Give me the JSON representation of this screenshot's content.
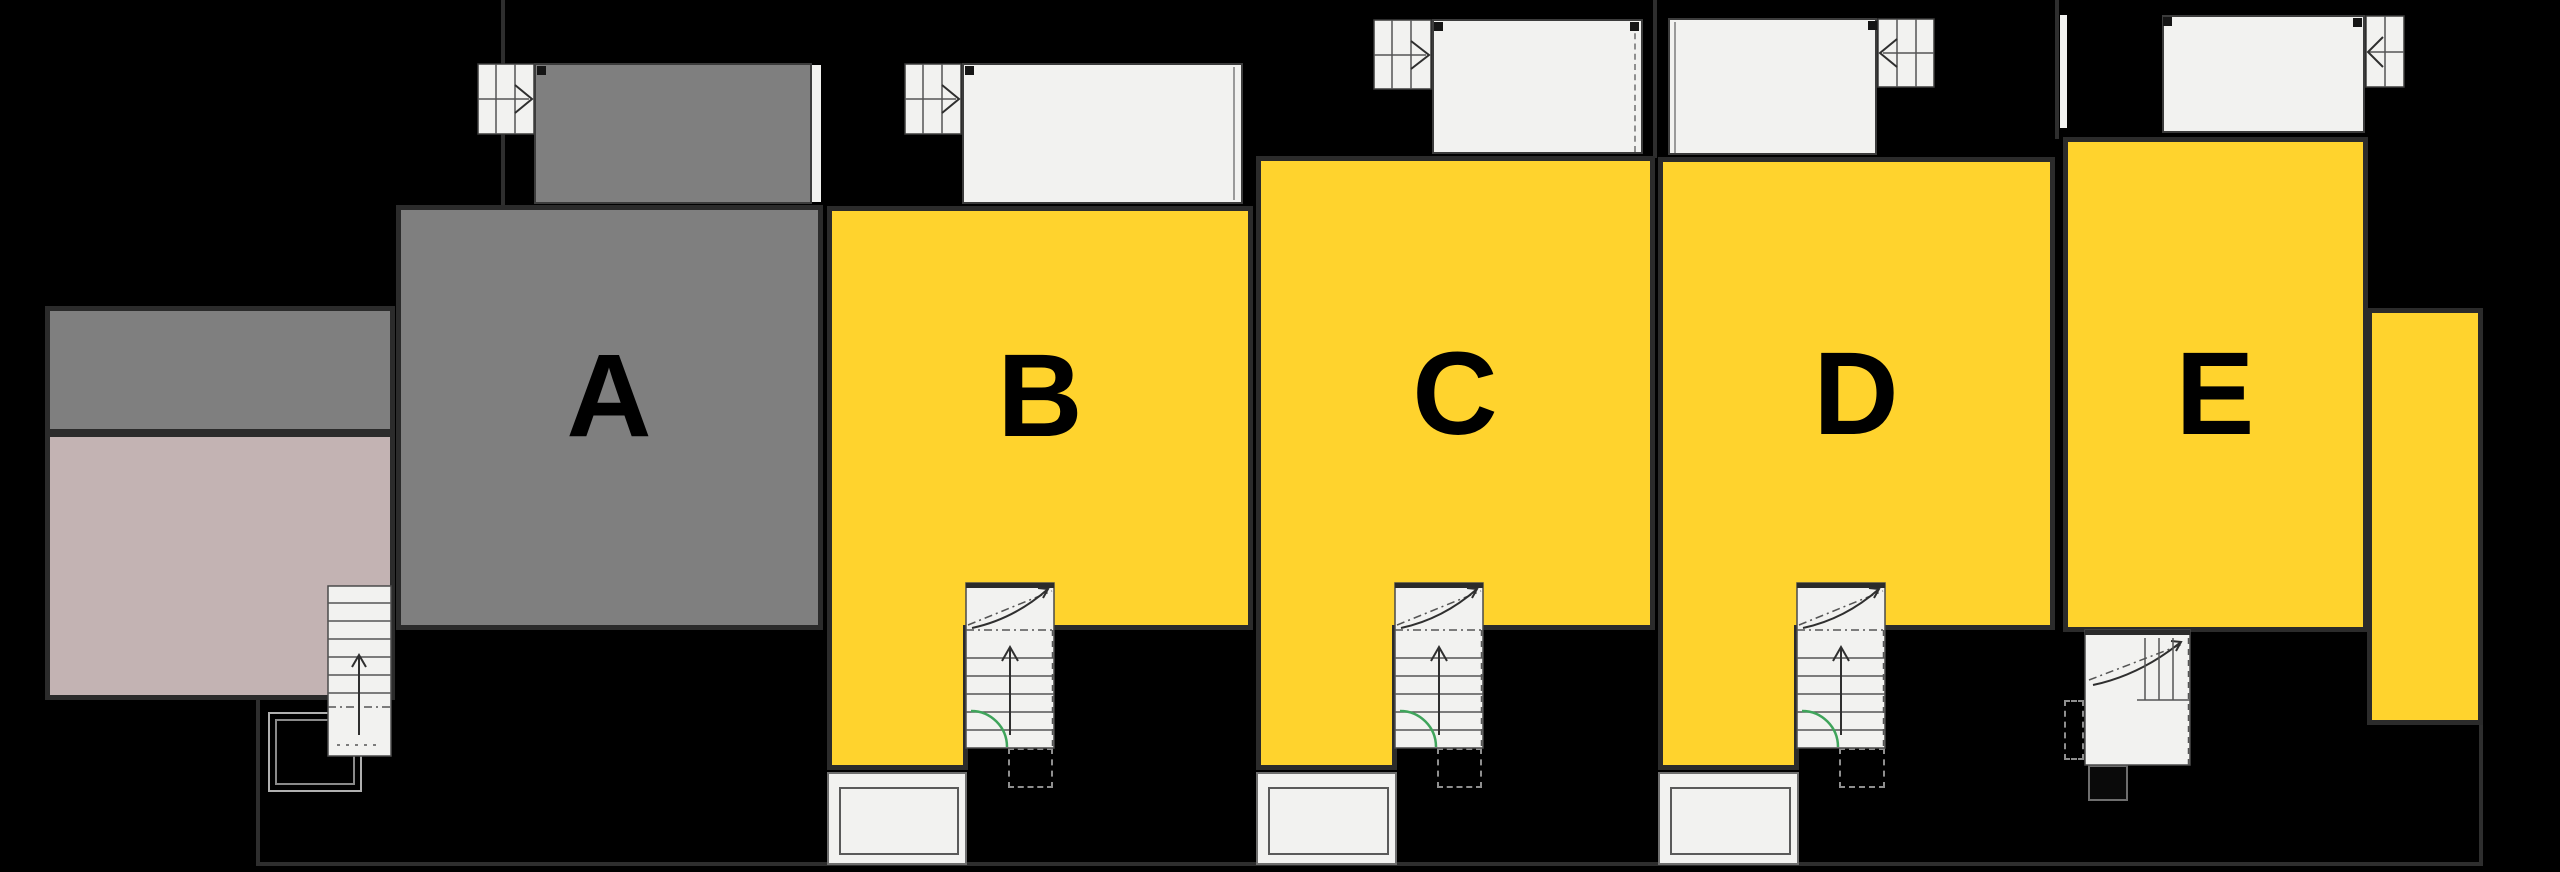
{
  "colors": {
    "bg": "#000000",
    "yellow": "#FFD32D",
    "gray": "#7F7F7F",
    "pink": "#C3B3B3",
    "paper": "#F2F2F0",
    "outline": "#2B2B2B",
    "bline": "#2E2E2E",
    "dline": "#4A4A4A",
    "green": "#3FA45B",
    "marker": "#151515"
  },
  "units": [
    {
      "label": "A",
      "fill": "gray"
    },
    {
      "label": "B",
      "fill": "yellow"
    },
    {
      "label": "C",
      "fill": "yellow"
    },
    {
      "label": "D",
      "fill": "yellow"
    },
    {
      "label": "E",
      "fill": "yellow"
    }
  ],
  "icons": {
    "top_stairs": "stairs-with-direction-arrow",
    "bottom_stairs": "staircase-with-up-arrow",
    "door": "door-swing-arc",
    "porch": "entrance-porch",
    "bin": "bin-store-square"
  }
}
